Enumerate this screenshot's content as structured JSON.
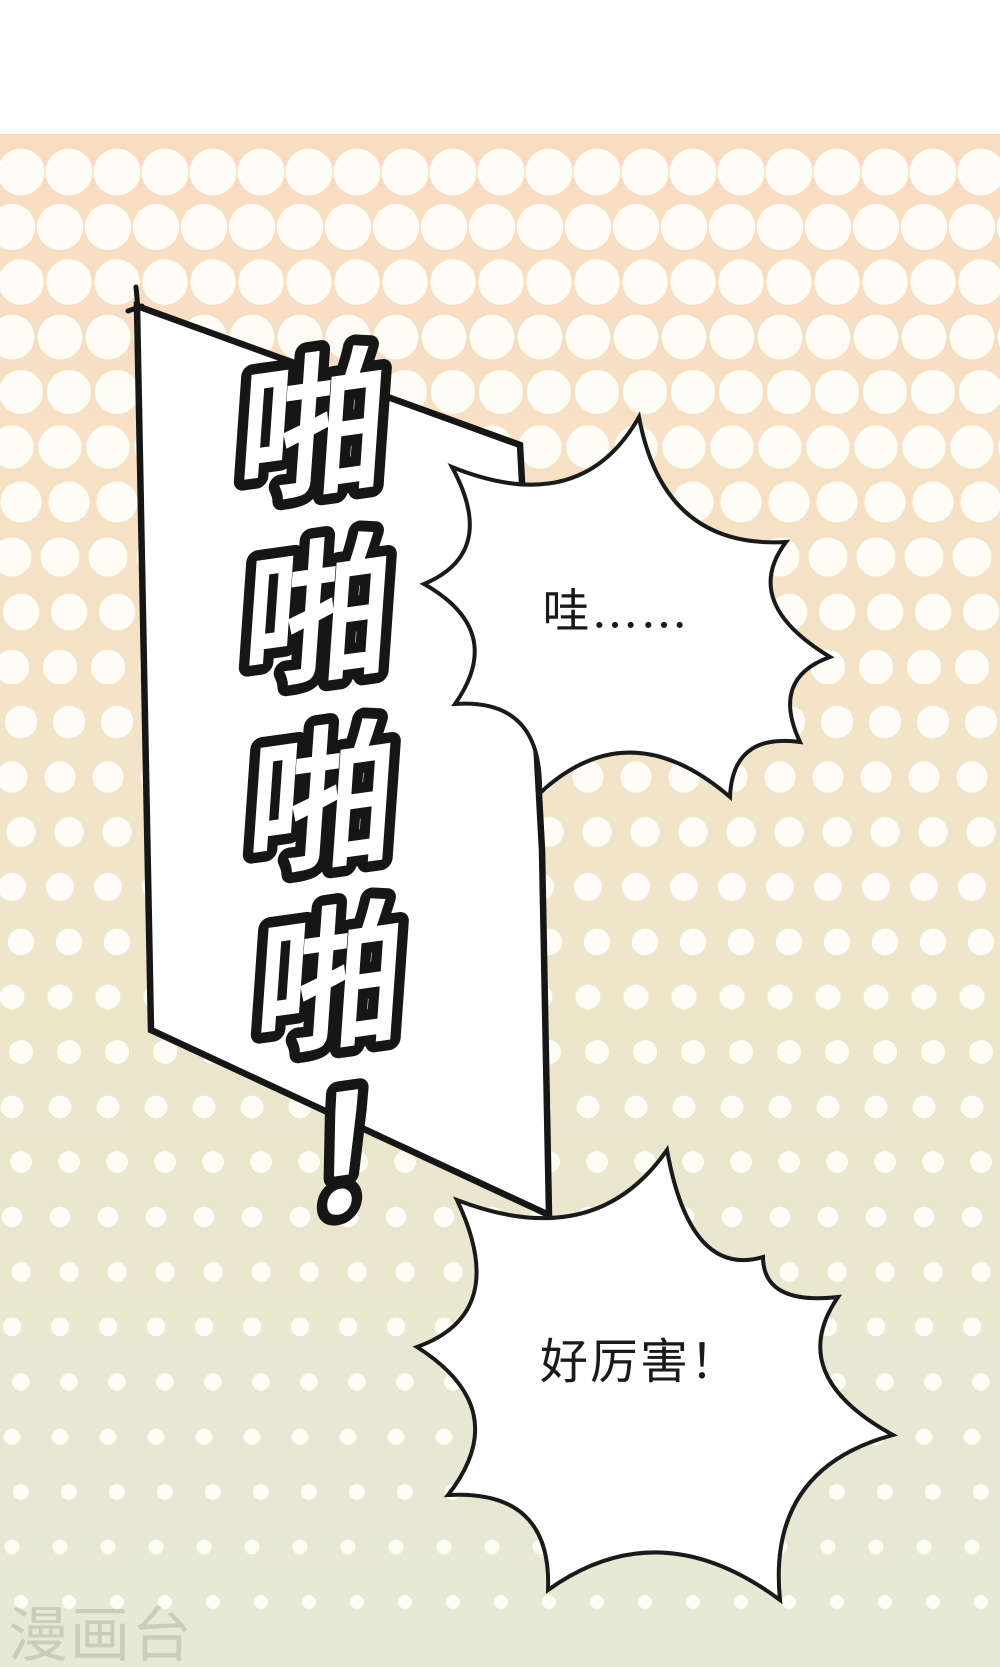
{
  "page": {
    "kind": "comic-page"
  },
  "sfx": {
    "full": "啪啪啪啪！",
    "chars": [
      "啪",
      "啪",
      "啪",
      "啪",
      "！"
    ]
  },
  "bubbles": [
    {
      "text": "哇……"
    },
    {
      "text": "好厉害！"
    }
  ],
  "watermark": {
    "text": "漫画台"
  },
  "colors": {
    "paper": "#ffffff",
    "ink": "#161616",
    "bubble_ink": "#1a1a1a",
    "dot": "#fdfdf6",
    "watermark": "#9aa392",
    "bg_gradient": [
      "#f8dcc0",
      "#f7e0c4",
      "#f1e5c9",
      "#ebe5cb",
      "#e8e8d2",
      "#e5e9d5"
    ]
  }
}
